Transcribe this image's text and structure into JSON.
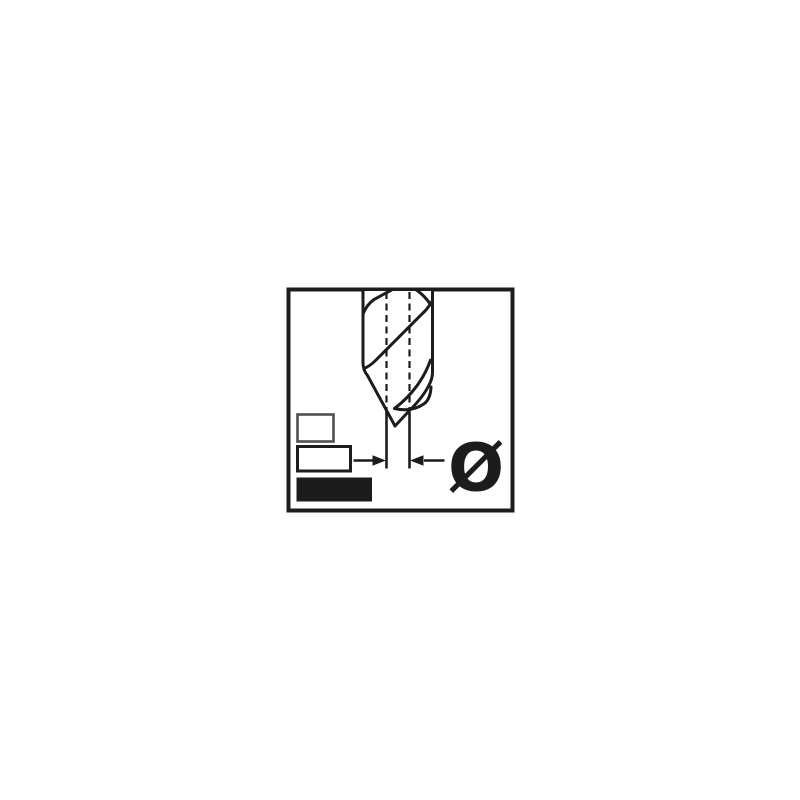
{
  "colors": {
    "ink": "#1c1c1c",
    "paper": "#ffffff",
    "muted_ink": "#4f4f4f"
  },
  "pictogram": {
    "diameter_symbol": "Ø",
    "icons": {
      "drill_bit": "twist-drill-bit-side-view",
      "centerlines": "dashed-vertical-centerlines",
      "dimension_arrows": "inward-pointing-width-arrows",
      "size_boxes": "stacked-rectangles-small-medium-large-filled"
    }
  }
}
